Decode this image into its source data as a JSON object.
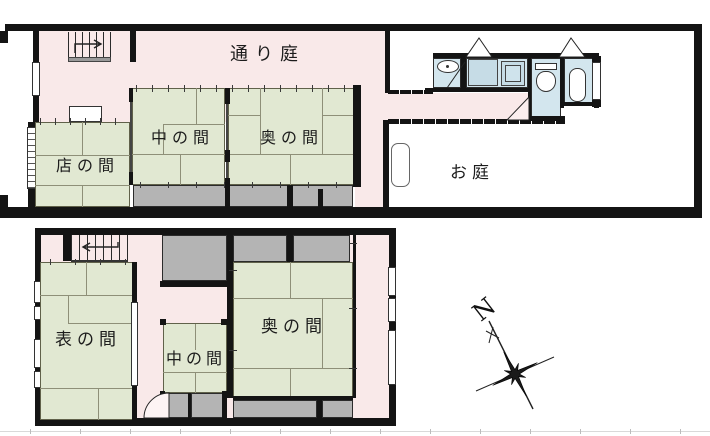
{
  "document": {
    "type": "machiya-floor-plan"
  },
  "floor1": {
    "passage_label": "通り庭",
    "shop_room_label": "店の間",
    "middle_room_label": "中の間",
    "back_room_label": "奥の間",
    "garden_label": "お庭"
  },
  "floor2": {
    "front_room_label": "表の間",
    "middle_room_label": "中の間",
    "back_room_label": "奥の間"
  },
  "compass": {
    "north_label": "N"
  },
  "colors": {
    "tatami": "#e1e8d2",
    "corridor_pink": "#f9e9e9",
    "closet_gray": "#b4b4b4",
    "bath_blue": "#d3e6ee",
    "wall": "#141414"
  }
}
